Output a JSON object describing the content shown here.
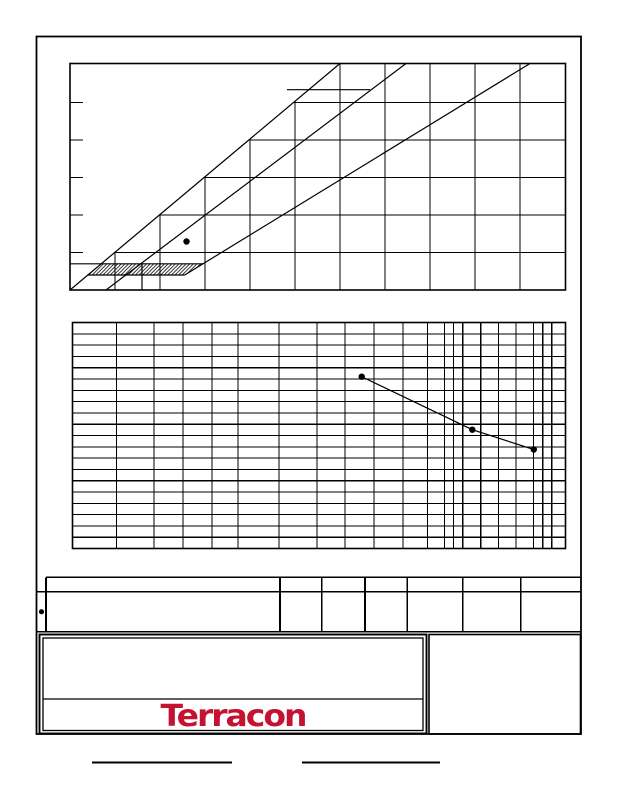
{
  "brand": {
    "logo_text": "Terracon",
    "logo_color": "#c41230"
  },
  "colors": {
    "ink": "#000000",
    "paper": "#ffffff"
  },
  "chart_data": [
    {
      "type": "scatter",
      "title": "Plasticity chart (Atterberg limits)",
      "xlabel": "Liquid Limit (not printed)",
      "ylabel": "Plasticity Index (not printed)",
      "xlim": [
        0,
        110
      ],
      "ylim": [
        0,
        60
      ],
      "grid": "10-unit grid clipped at PI=LL boundary",
      "reference_lines": [
        "PI=LL boundary line",
        "U-line PI=0.9(LL-8)",
        "A-line PI=0.73(LL-20)",
        "CL-ML hatched zone PI 4-7"
      ],
      "points": [
        {
          "liquid_limit": 26,
          "plasticity_index": 13
        }
      ],
      "legend_position": "none",
      "axis_text_visible": false
    },
    {
      "type": "line",
      "title": "Grain size distribution (semi-log grid)",
      "xlabel": "Grain size, log scale (not printed)",
      "ylabel": "Percent finer (not printed)",
      "ylim": [
        0,
        100
      ],
      "grid": "20 horizontal rows (5% each), log-spaced vertical lines",
      "series": [
        {
          "name": "sample-gradation",
          "percent_finer": [
            76,
            53,
            44
          ]
        }
      ],
      "legend_position": "none",
      "axis_text_visible": false
    }
  ],
  "layout": {
    "page": {
      "w": 618,
      "h": 800,
      "border": [
        36.5,
        36.5,
        544.5,
        697.5
      ],
      "border_w": 1.8
    },
    "plasticity": {
      "box": [
        70,
        63.5,
        495.5,
        226.5
      ],
      "ll0_x": 70,
      "px_per_ll": 4.5,
      "pi0_y": 290,
      "px_per_pi": 3.75,
      "ll_gridlines": [
        10,
        20,
        30,
        40,
        50,
        60,
        70,
        80,
        90,
        100
      ],
      "pi_gridlines": [
        10,
        20,
        30,
        40,
        50
      ],
      "tick_len": 13,
      "grid_clip_polygon": "70,290 340,63.5 565.5,63.5 565.5,290",
      "lines": {
        "identity": [
          70,
          290,
          340,
          63.5
        ],
        "u_line": [
          106,
          290,
          406,
          63.5
        ],
        "u_line_foot": [
          142,
          263.8,
          142,
          290
        ],
        "a_line": [
          184.7,
          275,
          530,
          63.5
        ],
        "pi7_line": [
          70,
          263.8,
          203.3,
          263.8
        ],
        "pi4_line": [
          88,
          275,
          184.7,
          275
        ],
        "label_fragment": [
          287,
          89.7,
          370,
          89.7
        ]
      },
      "hatch_polygon": "101.5,263.8 203.3,263.8 184.7,275 88,275",
      "point_px": [
        186.5,
        241.5
      ],
      "point_r": 3.2
    },
    "gradation": {
      "box": [
        72.5,
        322.5,
        493,
        226
      ],
      "x_gridlines_px": [
        116.3,
        154,
        183,
        212,
        238,
        279,
        317,
        345,
        374,
        403,
        427.3,
        444.3,
        453.3,
        462.7,
        480.7,
        498.3,
        516,
        533.3,
        542.7,
        551.7
      ],
      "rows": 20,
      "points_px": [
        [
          361.7,
          376.7
        ],
        [
          472.3,
          429.7
        ],
        [
          533.8,
          449.5
        ]
      ],
      "point_r": 3.2
    },
    "legend_table": {
      "h_lines": [
        [
          46,
          577.3,
          580.5,
          577.3
        ],
        [
          37,
          591.7,
          580.5,
          591.7
        ],
        [
          37,
          631.7,
          580.5,
          631.7
        ]
      ],
      "v_lines_x": [
        46,
        280,
        321.7,
        365,
        407.3,
        462.7,
        520.7
      ],
      "v_top": 577.3,
      "v_bottom": 631.7,
      "symbol_px": [
        41.5,
        611.7
      ],
      "symbol_r": 2.6
    },
    "title_block": {
      "outer": [
        39.5,
        634.5,
        387,
        99
      ],
      "inner": [
        43,
        638,
        380,
        92.5
      ],
      "divider": [
        43,
        699,
        423,
        699
      ],
      "logo_band": [
        43,
        700,
        380,
        30
      ]
    },
    "right_pane": [
      429,
      634.5,
      151.5,
      99.5
    ],
    "signature_lines": [
      [
        92,
        762.5,
        232,
        762.5
      ],
      [
        302,
        762.5,
        440,
        762.5
      ]
    ],
    "stroke": {
      "chart_border": 1.6,
      "grid": 1.1,
      "diag": 1.2,
      "table": 1.6,
      "tb_outer": 1.9,
      "tb_inner": 1.3,
      "sig": 2.2
    }
  }
}
